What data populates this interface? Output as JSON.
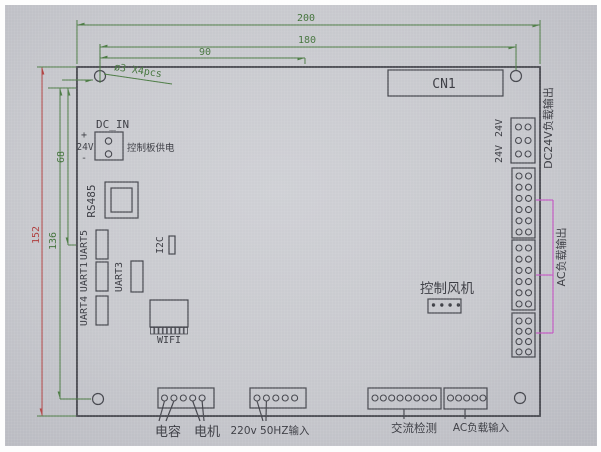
{
  "dims": {
    "d200": "200",
    "d180": "180",
    "d90": "90",
    "d152": "152",
    "d136": "136",
    "d68": "68",
    "hole_note": "ø3 X4pcs"
  },
  "labels": {
    "cn1": "CN1",
    "dc_in": "DC_IN",
    "plus": "+",
    "v24": "24V",
    "minus": "-",
    "board_power": "控制板供电",
    "rs485": "RS485",
    "uart5": "UART5",
    "uart1": "UART1",
    "uart4": "UART4",
    "uart3": "UART3",
    "i2c": "I2C",
    "wifi": "WIFI",
    "fan_ctrl": "控制风机",
    "v24_out_a": "24V",
    "v24_out_b": "24V",
    "dc24_out": "DC24V负载输出",
    "ac_out": "AC负载输出",
    "cap": "电容",
    "motor": "电机",
    "mains_in": "220v 50HZ输入",
    "ac_detect": "交流检测",
    "ac_load_in": "AC负载输入"
  },
  "connectors": {
    "dc_in_pins": 2,
    "right_dc24v_rows": 3,
    "right_ac1_rows": 6,
    "right_ac2_rows": 6,
    "right_ac3_rows": 4,
    "fan_pins": 4,
    "wifi_pins": 9,
    "bottom_cap_motor_pins": 5,
    "bottom_mains_pins": 5,
    "bottom_ac_detect_pins": 8,
    "bottom_ac_load_pins": 5
  },
  "colors": {
    "dimension_green": "#4a7a42",
    "dimension_red": "#b04040",
    "bracket_magenta": "#c45cc4",
    "line_dark": "#44454c",
    "background": "#c9cad0"
  }
}
